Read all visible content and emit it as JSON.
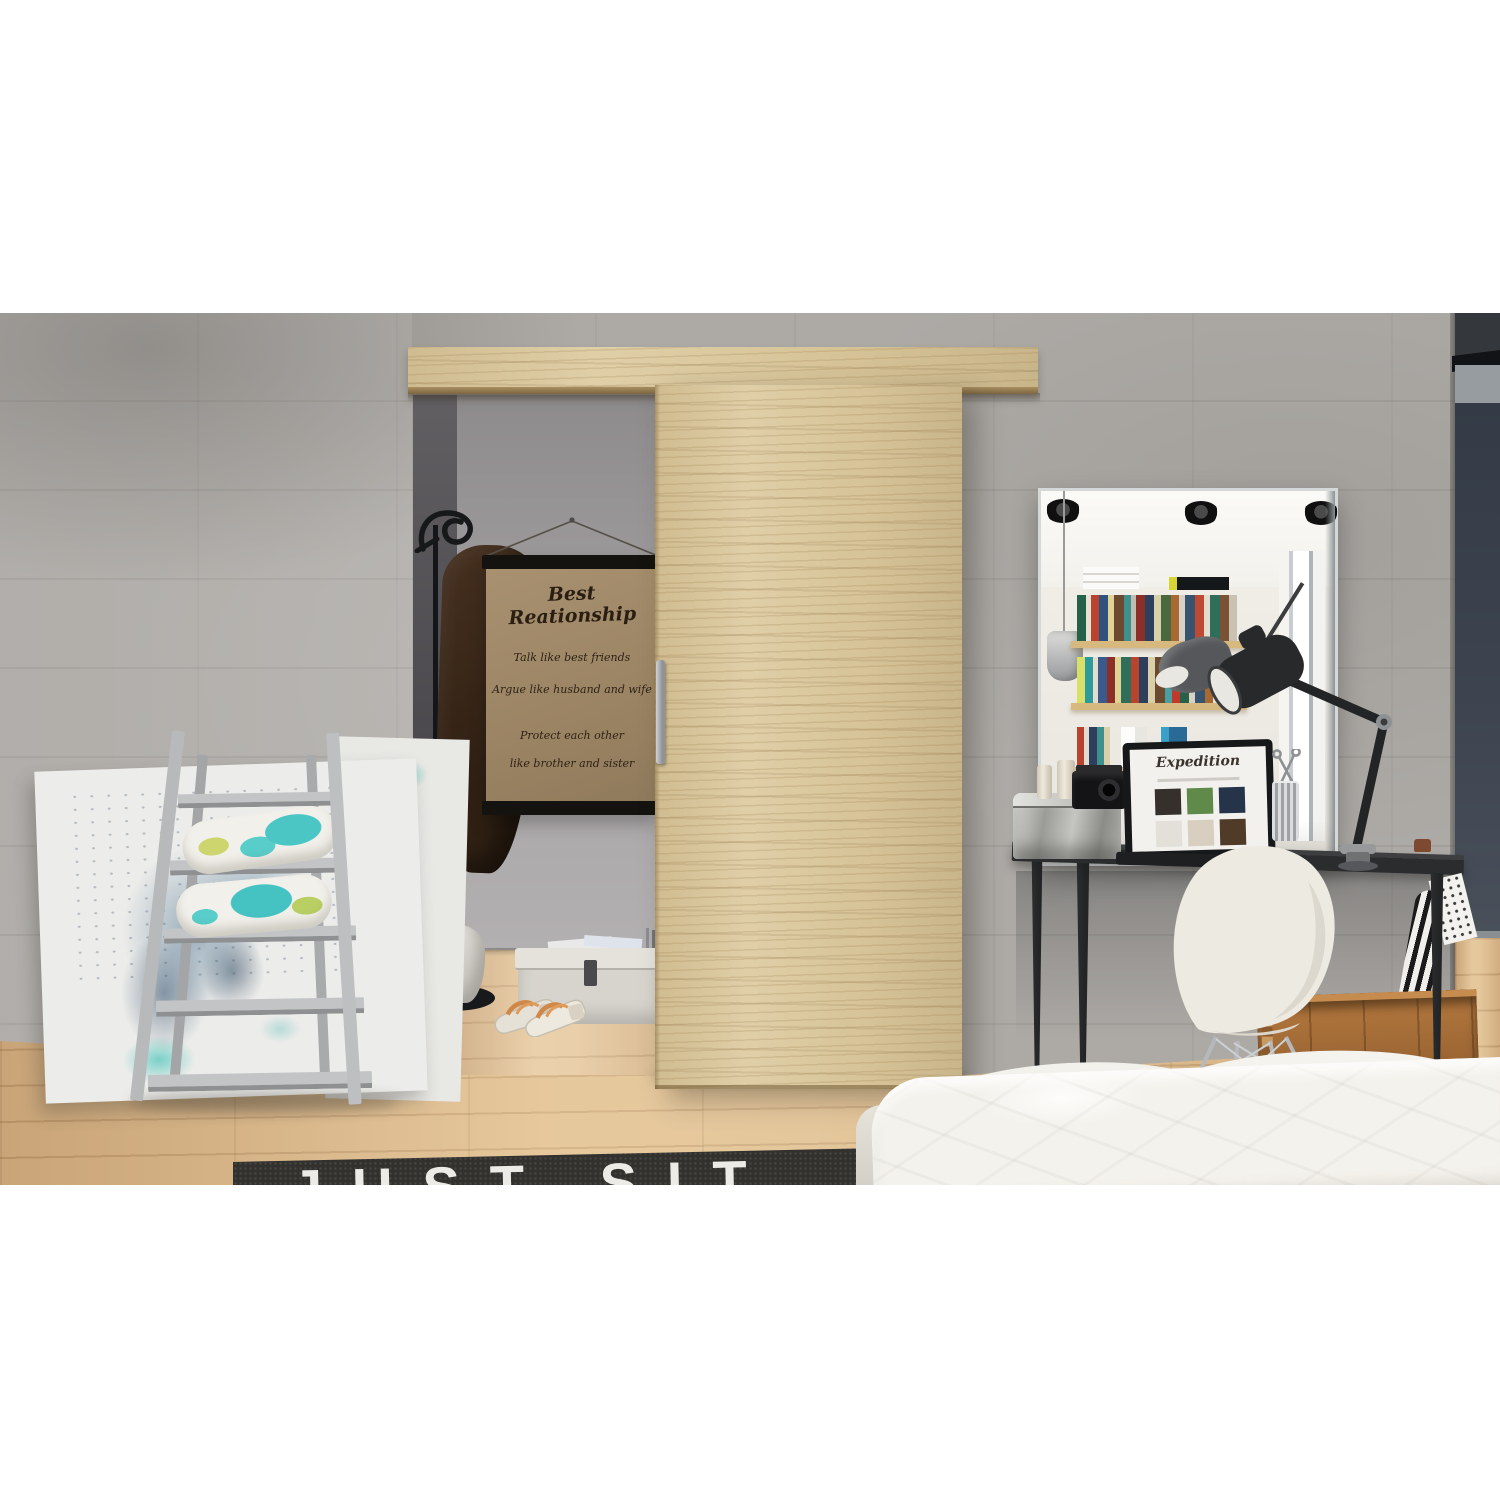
{
  "poster": {
    "title": "Best Reationship",
    "lines": [
      "Talk like best friends",
      "Argue like husband and wife",
      "Protect each other",
      "like brother and sister"
    ]
  },
  "rug": {
    "text": "JUST SIT"
  },
  "laptop": {
    "logo": "Expedition"
  },
  "colors": {
    "background": "#ffffff",
    "concrete_wall": "#adaaa6",
    "oak_wood": "#dcc99d",
    "floor_wood": "#debc8e",
    "dark_wall": "#3d4450",
    "desk_black": "#2a2c2e",
    "rug_black": "#32312e",
    "accent_teal": "#4cc6c4",
    "chair_white": "#edeae2",
    "poster_paper": "#a08a69",
    "coat_brown": "#3f2a1e"
  }
}
